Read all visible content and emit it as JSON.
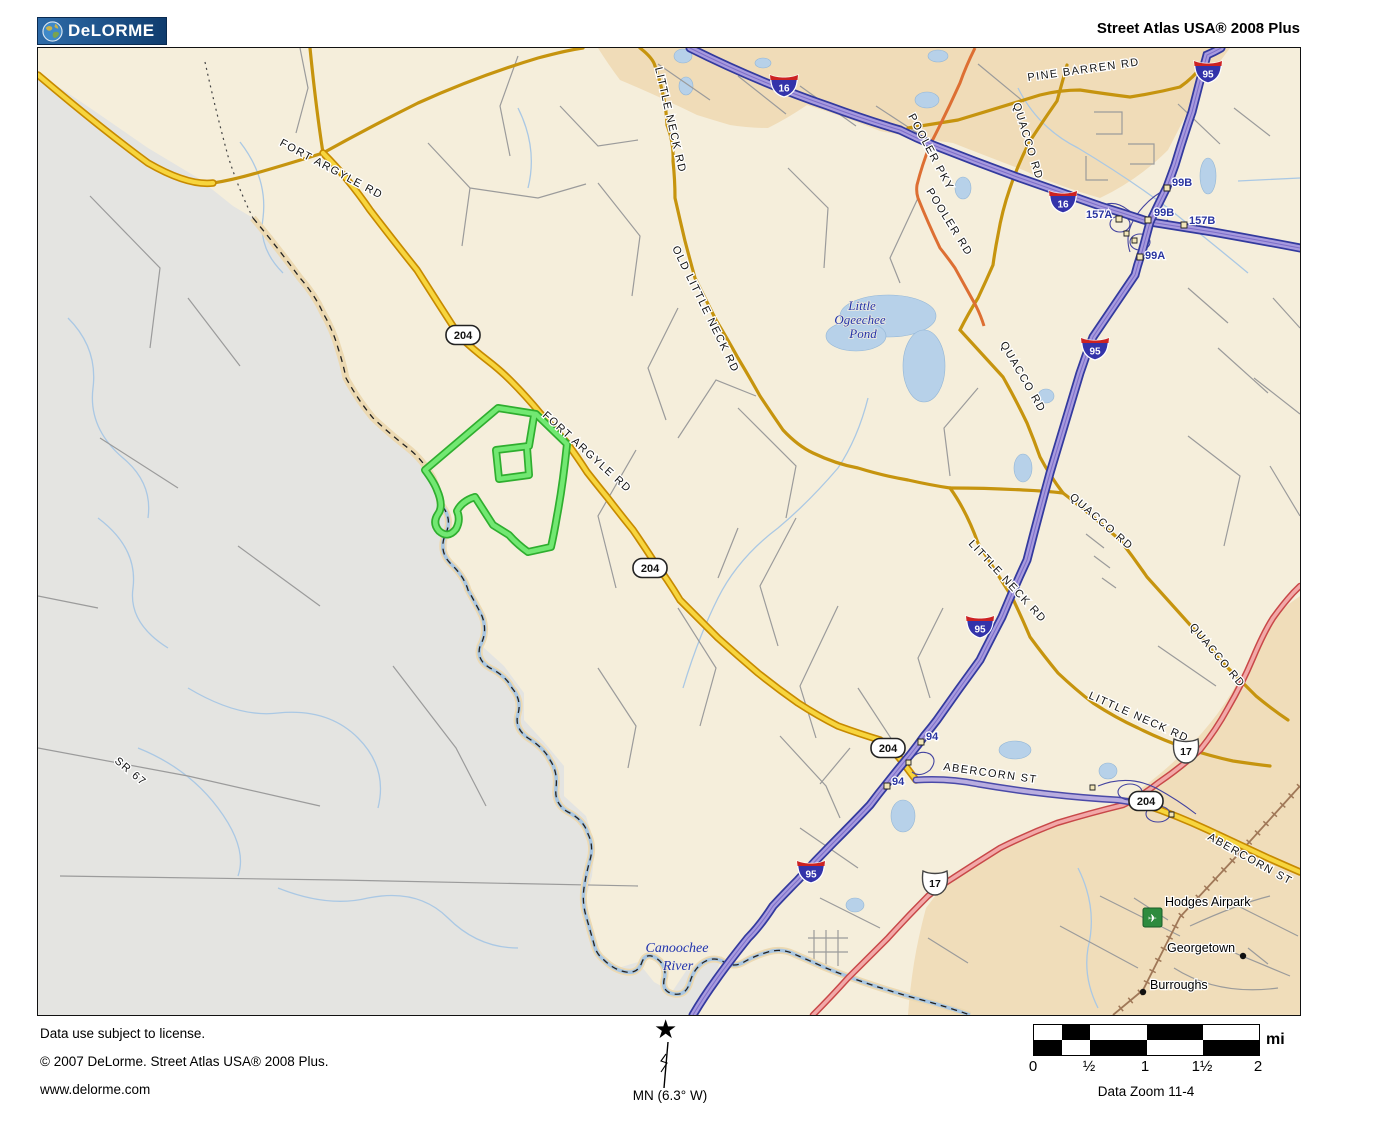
{
  "header": {
    "logo_text": "DeLORME",
    "title": "Street Atlas USA® 2008 Plus"
  },
  "map": {
    "road_labels": {
      "fort_argyle": "FORT ARGYLE RD",
      "old_little_neck": "OLD LITTLE NECK RD",
      "little_neck": "LITTLE NECK RD",
      "pine_barren": "PINE BARREN RD",
      "pooler_pky": "POOLER PKY",
      "pooler_rd": "POOLER RD",
      "quacco": "QUACCO RD",
      "abercorn": "ABERCORN ST",
      "sr67": "SR 67"
    },
    "water_labels": {
      "pond_line1": "Little",
      "pond_line2": "Ogeechee",
      "pond_line3": "Pond",
      "river_line1": "Canoochee",
      "river_line2": "River"
    },
    "place_labels": {
      "hodges_airpark": "Hodges Airpark",
      "georgetown": "Georgetown",
      "burroughs": "Burroughs"
    },
    "shields": {
      "i95": "95",
      "i16": "16",
      "sr204": "204",
      "us17": "17"
    },
    "exits": {
      "e94": "94",
      "e99a": "99A",
      "e99b": "99B",
      "e157a": "157A",
      "e157b": "157B"
    },
    "colors": {
      "interstate_fill": "#a79ade",
      "interstate_casing": "#333a9e",
      "state_route_yellow": "#f7d53e",
      "gold_road": "#c6940e",
      "us_highway_red": "#f2a8a8",
      "highlight_route_green": "#72e872",
      "water": "#b7d1e9",
      "urban_tan": "#f0dcb8",
      "rural_gray": "#e4e4e1",
      "map_cream": "#f5eedb"
    }
  },
  "footer": {
    "license": "Data use subject to license.",
    "copyright": "© 2007 DeLorme. Street Atlas USA® 2008 Plus.",
    "website": "www.delorme.com",
    "north_symbol": "★",
    "north_label": "MN (6.3° W)",
    "scale_unit": "mi",
    "scale_ticks": [
      "0",
      "½",
      "1",
      "1½",
      "2"
    ],
    "data_zoom": "Data Zoom 11-4"
  }
}
